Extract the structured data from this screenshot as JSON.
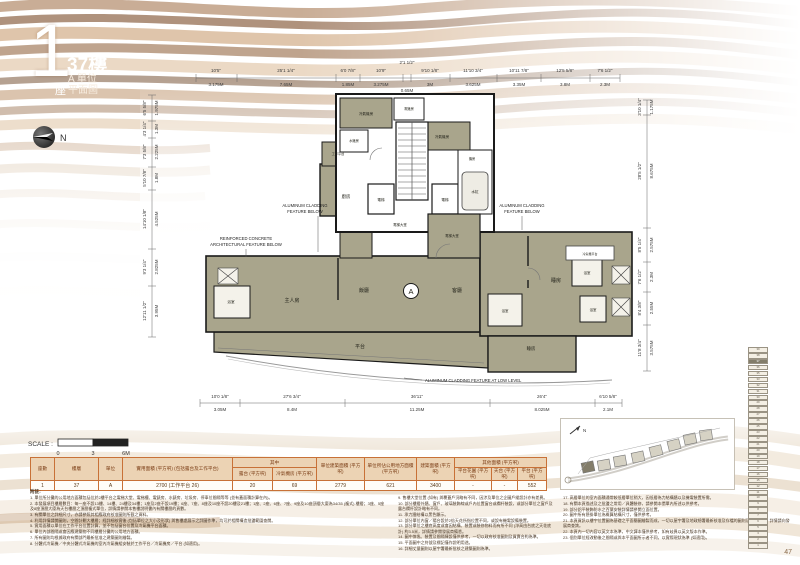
{
  "header": {
    "block_number": "1",
    "block_suffix": "座",
    "floor": "37樓",
    "unit": "A 單位",
    "plan_type": "平面圖",
    "north": "N"
  },
  "scale_bar": {
    "label": "SCALE :",
    "t0": "0",
    "t1": "3",
    "t2": "6M"
  },
  "dims": {
    "top": [
      {
        "ft": "10'5\"",
        "m": "3.175M"
      },
      {
        "ft": "25'1 1/4\"",
        "m": "7.65M"
      },
      {
        "ft": "6'0 7/8\"",
        "m": "1.85M"
      },
      {
        "ft": "10'9\"",
        "m": "3.275M"
      },
      {
        "ft": "2'1 1/2\"",
        "m": "0.65M"
      },
      {
        "ft": "9'10 1/8\"",
        "m": "3M"
      },
      {
        "ft": "11'10 3/4\"",
        "m": "3.625M"
      },
      {
        "ft": "10'11 7/8\"",
        "m": "3.35M"
      },
      {
        "ft": "12'5 5/8\"",
        "m": "3.8M"
      },
      {
        "ft": "7'6 1/2\"",
        "m": "2.3M"
      }
    ],
    "bottom": [
      {
        "ft": "10'0 1/8\"",
        "m": "3.05M"
      },
      {
        "ft": "27'6 3/4\"",
        "m": "8.4M"
      },
      {
        "ft": "36'11\"",
        "m": "11.25M"
      },
      {
        "ft": "26'4\"",
        "m": "8.025M"
      },
      {
        "ft": "6'10 5/8\"",
        "m": "2.1M"
      }
    ],
    "left": [
      {
        "ft": "6'5 5/8\"",
        "m": "1.975M"
      },
      {
        "ft": "4'3 1/4\"",
        "m": "1.3M"
      },
      {
        "ft": "7'3 5/8\"",
        "m": "2.225M"
      },
      {
        "ft": "5'10 7/8\"",
        "m": "1.8M"
      },
      {
        "ft": "14'10 1/8\"",
        "m": "4.525M"
      },
      {
        "ft": "9'3 1/4\"",
        "m": "2.825M"
      },
      {
        "ft": "12'11 1/2\"",
        "m": "3.95M"
      }
    ],
    "right": [
      {
        "ft": "3'10 1/4\"",
        "m": "1.175M"
      },
      {
        "ft": "28'5 1/2\"",
        "m": "8.675M"
      },
      {
        "ft": "8'5 1/4\"",
        "m": "2.575M"
      },
      {
        "ft": "7'6 1/2\"",
        "m": "2.3M"
      },
      {
        "ft": "8'4 3/8\"",
        "m": "2.55M"
      },
      {
        "ft": "11'8 3/4\"",
        "m": "3.575M"
      }
    ]
  },
  "rooms": {
    "ac1": "冷氣機房",
    "ac2": "冷氣機房",
    "water_meter": "水錶房",
    "elec_meter": "電錶房",
    "utility": "工作平台",
    "plant": "機房",
    "tank": "水缸",
    "lift1": "電梯",
    "lift2": "電梯",
    "lobby1": "電梯大堂",
    "lobby2": "電梯大堂",
    "kitchen": "廚房",
    "bath1": "浴室",
    "bath2": "浴室",
    "bath3": "浴室",
    "bath4": "浴室",
    "master": "主人房",
    "dining": "飯廳",
    "living": "客廳",
    "bed1": "睡房",
    "bed2": "睡房",
    "terrace": "平台",
    "ac_platform": "冷氣機平台",
    "unit_mark": "A"
  },
  "annotations": {
    "alum_l1": "ALUMINUM CLADDING",
    "alum_l2": "FEATURE BELOW",
    "alum_r1": "ALUMINUM CLADDING",
    "alum_r2": "FEATURE BELOW",
    "rc1": "REINFORCED CONCRETE",
    "rc2": "ARCHITECTURAL FEATURE BELOW",
    "alum_low": "ALUMINUM CLADDING FEATURE AT LOW LEVEL"
  },
  "table": {
    "headers": {
      "block": "座數",
      "floor": "樓層",
      "unit": "單位",
      "saleable": "實用面積 (平方呎) (包括露台及工作平台)",
      "among": "其中",
      "balcony": "露台 (平方呎)",
      "ac_room": "冷氣機房 (平方呎)",
      "unit_gfa": "單位建築面積 (平方呎)",
      "common": "單位所佔公用地方面積 (平方呎)",
      "gfa": "建築面積 (平方呎)",
      "other": "其他面積 (平方呎)",
      "garden": "平台花園 (平方呎)",
      "roof": "天台 (平方呎)",
      "flat_roof": "平台 (平方呎)"
    },
    "row": {
      "block": "1",
      "floor": "37",
      "unit": "A",
      "saleable": "2700 (工作平台 26)",
      "balcony": "20",
      "ac_room": "69",
      "unit_gfa": "2779",
      "common": "621",
      "gfa": "3400",
      "garden": "-",
      "roof": "-",
      "flat_roof": "552"
    }
  },
  "notes": {
    "title": "附註:",
    "col1": [
      "1. 單位所分攤的公用地方面積包括位於2樓平台之電梯大堂、電梯槽、電錶房、水錶房、垃圾房、停車位間隔等等 (並有蓋面積計算在內)。",
      "2. 本發展項目樓層數目：每一座不設13樓、14樓、24樓及34樓；1座及2座不設19樓；6座、7座、8座及10座不設20樓及21樓；1座、2座、6座、7座、9座及10座頂層大廈為34/35 (複式) 樓層；3座、5座及8座頂層大廈為天台樓層之頂層複式單位，詳情請參閱本售樓說明書內有關樓層的頁數。",
      "3. 有關單位之詳細尺寸，亦請參照其相應政府核准圖則所載之資料。",
      "4. 利用詳情請閱圖則，空間計劃大樓層；經詳細核實後 (包括單位之大小及形狀) 與售樓處展示之詳圖作準，均可於相關構造批盪範圍查閱。",
      "5. 實用面積以單位在工作平台位置計算，並不包括窗台位置及冷氣機平台面積。",
      "6. 單位內部間隔或會因應建築物不同樓層分攤的公用地方面積。",
      "7. 所有圖則均根據政府有關部門最新批准之建築圖則繪製。",
      "8. 分體式冷氣機／中央分體式冷氣機的室內冷氣機組安裝於工作平台／冷氣機房／平台 (如適用)。"
    ],
    "col2": [
      "9. 售樓大堂位置 (如有) 與覆蓋戶況略有不同，因涉及單位之企圖戶縱設計亦有差異。",
      "10. 部分樓層外牆、窗戶、玻璃裝飾線或戶內位置窗台或欄杆裝設，或部分單位之窗戶及露台欄杆設計略有不同。",
      "11. 承力牆結構以黑色顯示。",
      "12. 部分單位內窗／陽台設於2倍天花所指位置不同，或設有機電設備裝置。",
      "13. 部分單位之樓底高度或會因結構、裝置或裝修物料而有所不同 (淨高由台底之天花底計) 約3.5米，詳情請參閱發展商備悉。",
      "14. 圖中傢俬、裝置及間隔陳設僅供參考，一切以政府核准圖則及買賣合約為準。",
      "15. 平面圖中之符號及標記僅作說明用途。",
      "16. 詳細丈量圖則以屋宇署最新批核之建築圖則為準。"
    ],
    "col3": [
      "17. 高層單位的室內面積通常較低層單位稍大，因低層為力結構牆以及機電裝置所需。",
      "18. 有關本頁描述及之批盪之常用／具體裝修，請參閱本價單內所述以供參考。",
      "19. 部分鋁平裝飾防水之百葉安裝詳情請參閱立面位置。",
      "20. 圖中所有懸掛單位為概算結構尺寸，僅供參考。",
      "21. 本頁資訊以樓宇位置圖為基礎之平面簡圖繪製而成，一切以屋宇署及地政總署最新核准及存檔的圖則及文件為準，詳情請向發展商查詢。",
      "22. 本頁內一切內容以英文本為準，中文譯本僅供參考，如有歧異以英文版本作準。",
      "23. 個別單位經改動後之間隔或與本平面圖所示者不同，以實際現狀為準 (如適用)。"
    ]
  },
  "floor_strip": {
    "floors": [
      "39",
      "38",
      "37",
      "36",
      "35",
      "33",
      "32",
      "31",
      "30",
      "29",
      "28",
      "27",
      "26",
      "25",
      "23",
      "22",
      "21",
      "20",
      "19",
      "18",
      "17",
      "16",
      "15",
      "12",
      "11",
      "10",
      "9",
      "8",
      "7",
      "6",
      "5",
      "3",
      "2",
      "1"
    ],
    "highlight": "37"
  },
  "key_plan": {
    "north": "N"
  },
  "page": {
    "number": "47"
  },
  "colors": {
    "wave_brown": "#8a5a32",
    "room_khaki": "#a9a58c",
    "table_border": "#c87137",
    "table_header_bg": "#ecd3b4"
  }
}
